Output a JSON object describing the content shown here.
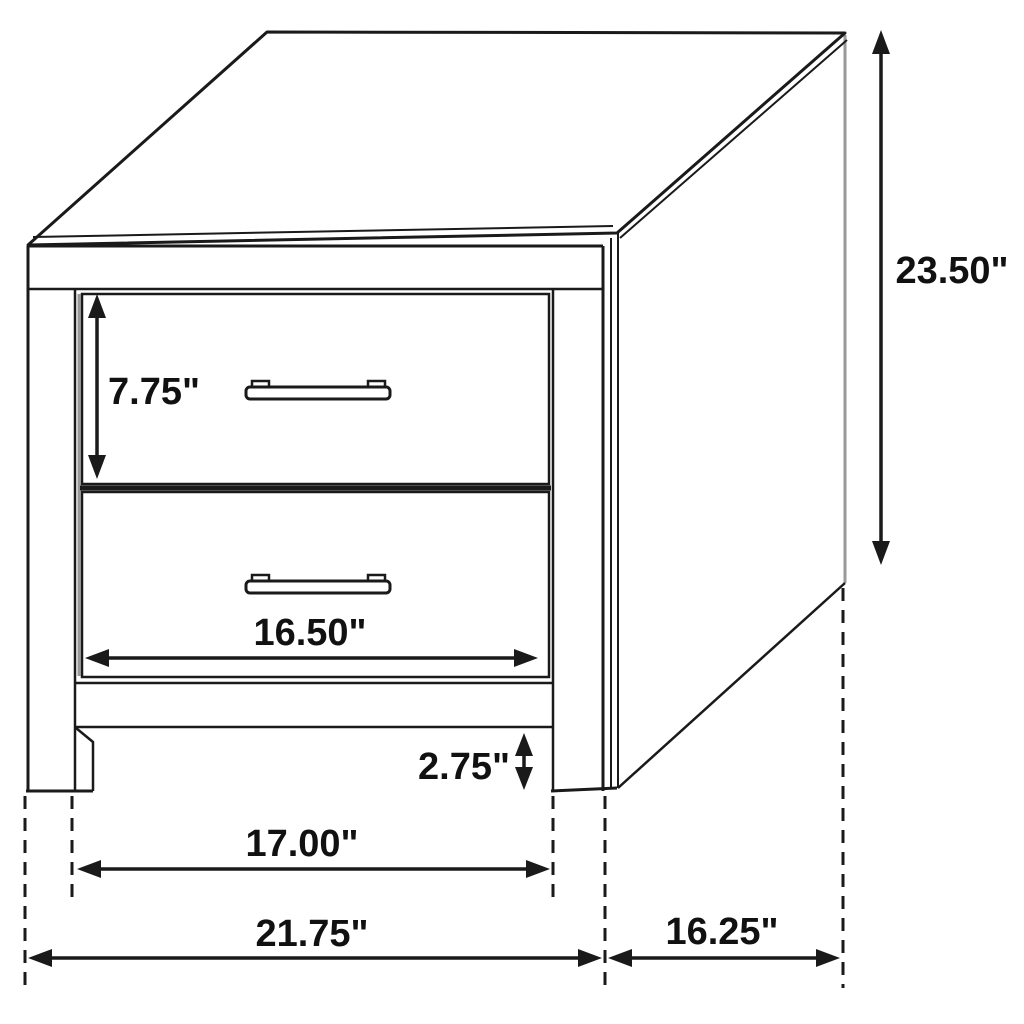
{
  "diagram": {
    "subject": "two-drawer nightstand dimension drawing",
    "background": "#ffffff",
    "line_color": "#1a1a1a",
    "dimensions": {
      "height": {
        "label": "23.50\"",
        "inches": 23.5
      },
      "top_drawer_height": {
        "label": "7.75\"",
        "inches": 7.75
      },
      "drawer_width": {
        "label": "16.50\"",
        "inches": 16.5
      },
      "leg_clearance": {
        "label": "2.75\"",
        "inches": 2.75
      },
      "leg_spacing": {
        "label": "17.00\"",
        "inches": 17.0
      },
      "overall_width": {
        "label": "21.75\"",
        "inches": 21.75
      },
      "depth": {
        "label": "16.25\"",
        "inches": 16.25
      }
    }
  }
}
